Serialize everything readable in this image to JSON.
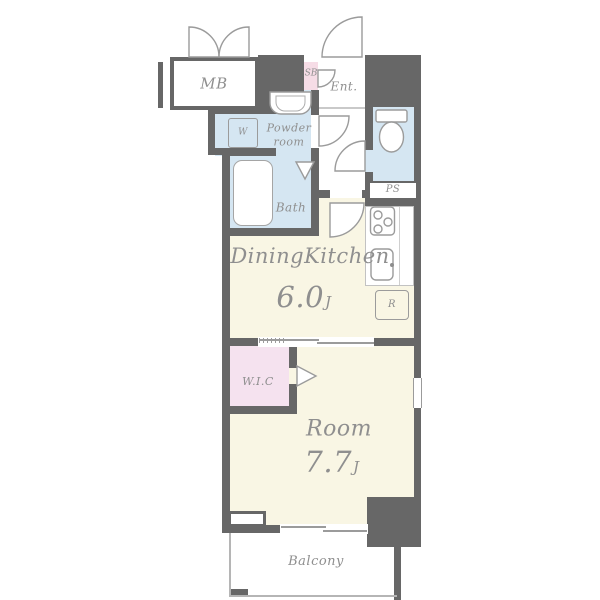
{
  "rooms": {
    "mb": {
      "label": "MB"
    },
    "sb": {
      "label": "SB"
    },
    "entrance": {
      "label": "Ent."
    },
    "powder_room": {
      "line1": "Powder",
      "line2": "room"
    },
    "washer": {
      "label": "W"
    },
    "bath": {
      "label": "Bath"
    },
    "ps": {
      "label": "PS"
    },
    "dining_kitchen": {
      "label": "DiningKitchen",
      "size_value": "6.0",
      "size_unit": "J"
    },
    "refrigerator": {
      "label": "R"
    },
    "wic": {
      "label": "W.I.C"
    },
    "room": {
      "label": "Room",
      "size_value": "7.7",
      "size_unit": "J"
    },
    "balcony": {
      "label": "Balcony"
    }
  },
  "icons": {
    "toilet": "toilet-icon",
    "washbasin": "washbasin-icon",
    "bathtub": "bathtub-icon",
    "stove": "stove-burners-icon",
    "sink": "kitchen-sink-icon",
    "swing_doors": "door-swing-arc-icon",
    "folding_door": "folding-door-triangle-icon",
    "sliding_door": "sliding-door-icon"
  },
  "colors": {
    "wall": "#676767",
    "wet": "#d5e6f2",
    "living": "#f9f6e4",
    "closet": "#f5e2ef",
    "shoebox": "#f6dce6",
    "line": "#9b9b9b",
    "text": "#8f8f8f"
  }
}
